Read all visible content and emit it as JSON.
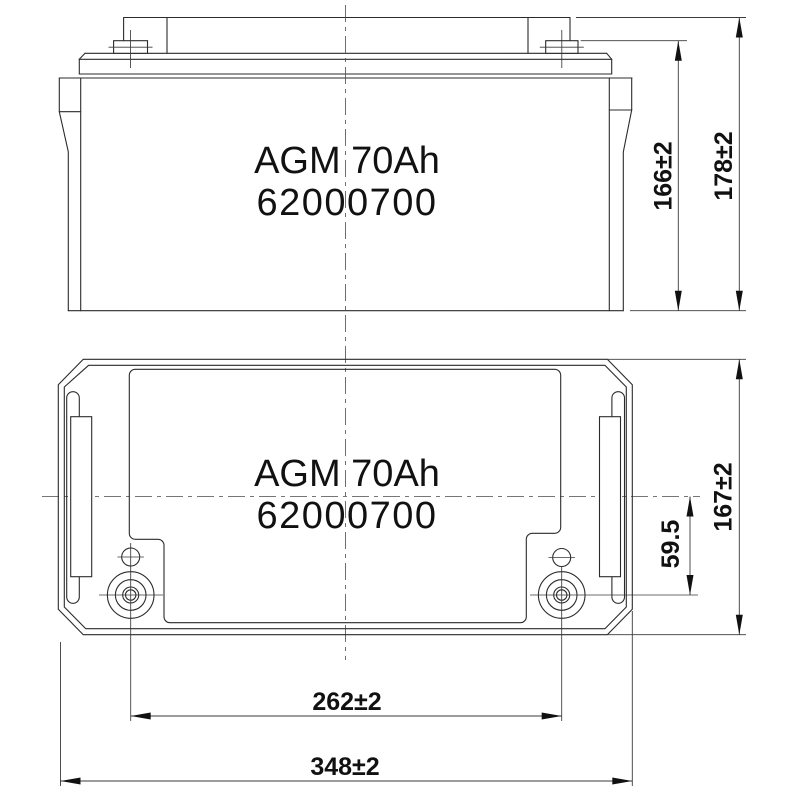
{
  "drawing": {
    "product": {
      "model": "AGM 70Ah",
      "part_number": "62000700"
    },
    "side_view": {
      "label_line1": "AGM 70Ah",
      "label_line2": "62000700",
      "dims": {
        "case_height": "166±2",
        "total_height": "178±2"
      }
    },
    "top_view": {
      "label_line1": "AGM 70Ah",
      "label_line2": "62000700",
      "dims": {
        "depth": "167±2",
        "terminal_offset": "59.5",
        "terminal_pitch": "262±2",
        "overall_width": "348±2"
      },
      "polarity": {
        "left": "positive",
        "right": "negative"
      }
    },
    "colors": {
      "line": "#2b2b2b",
      "background": "#ffffff",
      "dimension_text": "#111111"
    }
  }
}
